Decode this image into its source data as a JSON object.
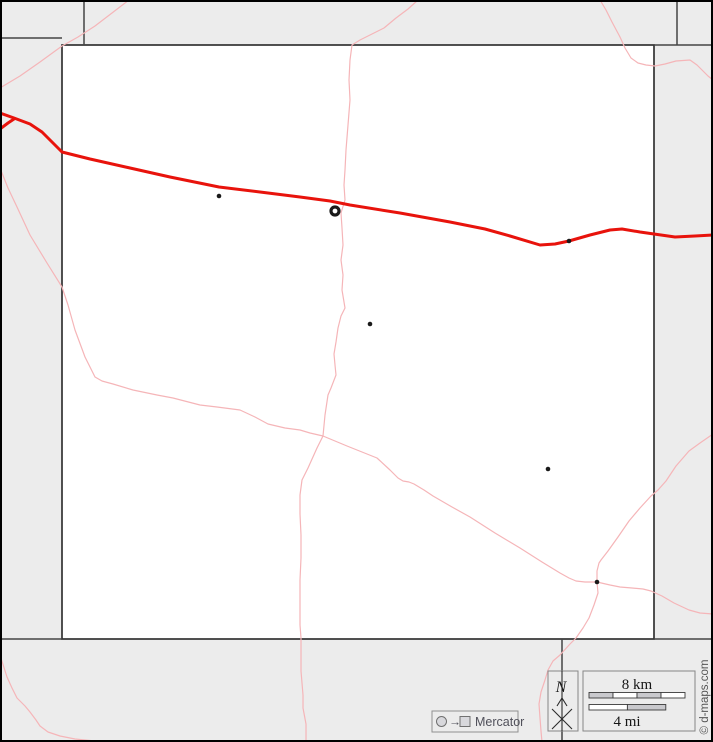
{
  "canvas": {
    "width": 713,
    "height": 742
  },
  "colors": {
    "background": "#ececec",
    "county_fill": "#ffffff",
    "county_border": "#333333",
    "boundary": "#454545",
    "outer_border": "#000000",
    "highway": "#e8130c",
    "road": "#f5b5b8",
    "town": "#1a1a1a",
    "scale_fill_gray": "#c9c9cd",
    "scale_fill_white": "#ffffff",
    "box_border": "#868686",
    "text_gray": "#50505a"
  },
  "map": {
    "county": {
      "x": 62,
      "y": 45,
      "width": 592,
      "height": 594
    },
    "boundaries": [
      {
        "name": "boundary-northwest-step",
        "points": [
          [
            0,
            38
          ],
          [
            62,
            38
          ]
        ]
      },
      {
        "name": "boundary-north-east-extension",
        "points": [
          [
            654,
            45
          ],
          [
            713,
            45
          ]
        ]
      },
      {
        "name": "boundary-north-divider-left",
        "points": [
          [
            84,
            0
          ],
          [
            84,
            45
          ]
        ]
      },
      {
        "name": "boundary-north-divider-right",
        "points": [
          [
            677,
            0
          ],
          [
            677,
            45
          ]
        ]
      },
      {
        "name": "boundary-south-west-extension",
        "points": [
          [
            0,
            639
          ],
          [
            62,
            639
          ]
        ]
      },
      {
        "name": "boundary-south-east-extension",
        "points": [
          [
            654,
            639
          ],
          [
            713,
            639
          ]
        ]
      },
      {
        "name": "boundary-south-divider",
        "points": [
          [
            562,
            639
          ],
          [
            562,
            742
          ]
        ]
      }
    ],
    "roads": [
      {
        "name": "road-northwest-diagonal",
        "points": [
          [
            0,
            88
          ],
          [
            20,
            76
          ],
          [
            40,
            62
          ],
          [
            62,
            46
          ],
          [
            78,
            37
          ],
          [
            95,
            26
          ],
          [
            112,
            13
          ],
          [
            129,
            0
          ]
        ]
      },
      {
        "name": "road-west-to-southeast",
        "points": [
          [
            0,
            168
          ],
          [
            8,
            188
          ],
          [
            17,
            207
          ],
          [
            30,
            235
          ],
          [
            47,
            263
          ],
          [
            62,
            287
          ],
          [
            68,
            305
          ],
          [
            75,
            330
          ],
          [
            85,
            357
          ],
          [
            95,
            377
          ],
          [
            102,
            381
          ],
          [
            113,
            384
          ],
          [
            133,
            390
          ],
          [
            157,
            395
          ],
          [
            173,
            398
          ],
          [
            200,
            405
          ],
          [
            217,
            407
          ],
          [
            240,
            410
          ],
          [
            255,
            417
          ],
          [
            268,
            424
          ],
          [
            285,
            428
          ],
          [
            300,
            430
          ],
          [
            310,
            433
          ],
          [
            323,
            436
          ],
          [
            335,
            441
          ],
          [
            347,
            446
          ],
          [
            362,
            452
          ],
          [
            377,
            458
          ],
          [
            390,
            470
          ],
          [
            398,
            478
          ],
          [
            403,
            481
          ],
          [
            409,
            482
          ],
          [
            414,
            484
          ],
          [
            424,
            490
          ],
          [
            433,
            496
          ],
          [
            452,
            507
          ],
          [
            470,
            517
          ],
          [
            495,
            533
          ],
          [
            520,
            548
          ],
          [
            542,
            562
          ],
          [
            560,
            573
          ],
          [
            569,
            578
          ],
          [
            576,
            581
          ],
          [
            585,
            582
          ],
          [
            597,
            582
          ],
          [
            610,
            585
          ],
          [
            620,
            587
          ],
          [
            632,
            588
          ],
          [
            643,
            589
          ],
          [
            651,
            591
          ],
          [
            662,
            596
          ],
          [
            674,
            603
          ],
          [
            689,
            610
          ],
          [
            700,
            613
          ],
          [
            713,
            614
          ]
        ]
      },
      {
        "name": "road-top-center-vertical",
        "points": [
          [
            418,
            0
          ],
          [
            408,
            9
          ],
          [
            396,
            18
          ],
          [
            384,
            28
          ],
          [
            372,
            34
          ],
          [
            360,
            40
          ],
          [
            352,
            45
          ],
          [
            350,
            60
          ],
          [
            349,
            80
          ],
          [
            350,
            100
          ],
          [
            348,
            125
          ],
          [
            346,
            150
          ],
          [
            345,
            170
          ],
          [
            344,
            185
          ],
          [
            345,
            200
          ],
          [
            341,
            213
          ],
          [
            342,
            228
          ],
          [
            343,
            245
          ],
          [
            341,
            260
          ],
          [
            343,
            275
          ],
          [
            342,
            290
          ],
          [
            345,
            308
          ],
          [
            341,
            316
          ],
          [
            338,
            328
          ],
          [
            336,
            342
          ],
          [
            334,
            354
          ],
          [
            335,
            365
          ],
          [
            336,
            375
          ],
          [
            331,
            388
          ],
          [
            328,
            395
          ],
          [
            325,
            415
          ],
          [
            323,
            436
          ],
          [
            317,
            448
          ],
          [
            308,
            468
          ],
          [
            302,
            480
          ],
          [
            300,
            495
          ],
          [
            300,
            514
          ],
          [
            301,
            535
          ],
          [
            301,
            558
          ],
          [
            300,
            580
          ],
          [
            300,
            605
          ],
          [
            300,
            625
          ],
          [
            301,
            638
          ],
          [
            301,
            655
          ],
          [
            301,
            671
          ],
          [
            303,
            695
          ],
          [
            303,
            708
          ],
          [
            306,
            724
          ],
          [
            306,
            742
          ]
        ]
      },
      {
        "name": "road-northeast-to-town",
        "points": [
          [
            713,
            434
          ],
          [
            700,
            443
          ],
          [
            689,
            451
          ],
          [
            676,
            466
          ],
          [
            666,
            481
          ],
          [
            658,
            490
          ],
          [
            651,
            496
          ],
          [
            640,
            508
          ],
          [
            629,
            521
          ],
          [
            618,
            537
          ],
          [
            608,
            551
          ],
          [
            601,
            560
          ],
          [
            599,
            563
          ],
          [
            597,
            571
          ],
          [
            597,
            582
          ]
        ]
      },
      {
        "name": "road-town-to-south",
        "points": [
          [
            597,
            582
          ],
          [
            598,
            593
          ],
          [
            594,
            605
          ],
          [
            589,
            618
          ],
          [
            583,
            628
          ],
          [
            576,
            638
          ],
          [
            570,
            644
          ],
          [
            560,
            655
          ],
          [
            553,
            661
          ],
          [
            548,
            670
          ],
          [
            545,
            680
          ],
          [
            541,
            692
          ],
          [
            539,
            704
          ],
          [
            540,
            718
          ],
          [
            541,
            731
          ],
          [
            542,
            742
          ]
        ]
      },
      {
        "name": "road-northeast-corner-curve",
        "points": [
          [
            600,
            0
          ],
          [
            606,
            10
          ],
          [
            612,
            22
          ],
          [
            620,
            37
          ],
          [
            625,
            48
          ],
          [
            631,
            58
          ],
          [
            638,
            63
          ],
          [
            646,
            65
          ],
          [
            655,
            66
          ],
          [
            665,
            64
          ],
          [
            676,
            61
          ],
          [
            690,
            60
          ],
          [
            697,
            65
          ],
          [
            703,
            71
          ],
          [
            708,
            76
          ],
          [
            713,
            80
          ]
        ]
      },
      {
        "name": "road-southwest-diagonal",
        "points": [
          [
            0,
            655
          ],
          [
            7,
            677
          ],
          [
            12,
            688
          ],
          [
            17,
            698
          ],
          [
            25,
            706
          ],
          [
            30,
            712
          ],
          [
            36,
            720
          ],
          [
            40,
            726
          ],
          [
            48,
            732
          ],
          [
            60,
            736
          ],
          [
            75,
            739
          ],
          [
            95,
            741
          ],
          [
            112,
            742
          ]
        ]
      }
    ],
    "highways": [
      {
        "name": "red-highway",
        "points": [
          [
            0,
            113
          ],
          [
            14,
            118
          ],
          [
            30,
            124
          ],
          [
            42,
            132
          ],
          [
            52,
            142
          ],
          [
            62,
            152
          ],
          [
            90,
            159
          ],
          [
            130,
            168
          ],
          [
            170,
            177
          ],
          [
            219,
            187
          ],
          [
            260,
            192
          ],
          [
            300,
            197
          ],
          [
            330,
            201
          ],
          [
            350,
            205
          ],
          [
            400,
            213
          ],
          [
            450,
            222
          ],
          [
            485,
            229
          ],
          [
            510,
            236
          ],
          [
            540,
            245
          ],
          [
            555,
            244
          ],
          [
            569,
            241
          ],
          [
            590,
            235
          ],
          [
            610,
            230
          ],
          [
            622,
            229
          ],
          [
            640,
            232
          ],
          [
            654,
            234
          ],
          [
            675,
            237
          ],
          [
            695,
            236
          ],
          [
            713,
            235
          ]
        ]
      },
      {
        "name": "red-highway-spur",
        "points": [
          [
            0,
            129
          ],
          [
            8,
            123
          ],
          [
            14,
            119
          ]
        ]
      }
    ],
    "towns": [
      {
        "name": "town-marker",
        "x": 219,
        "y": 196,
        "type": "town"
      },
      {
        "name": "county-seat-marker",
        "x": 335,
        "y": 211,
        "type": "seat"
      },
      {
        "name": "town-marker",
        "x": 569,
        "y": 241,
        "type": "town"
      },
      {
        "name": "town-marker",
        "x": 370,
        "y": 324,
        "type": "town"
      },
      {
        "name": "town-marker",
        "x": 548,
        "y": 469,
        "type": "town"
      },
      {
        "name": "town-marker",
        "x": 597,
        "y": 582,
        "type": "town"
      }
    ]
  },
  "legend": {
    "projection": {
      "label": "Mercator",
      "arrow": "→"
    },
    "north": {
      "label": "N"
    },
    "scale": {
      "km_label": "8 km",
      "mi_label": "4 mi"
    },
    "credit": "© d-maps.com"
  }
}
